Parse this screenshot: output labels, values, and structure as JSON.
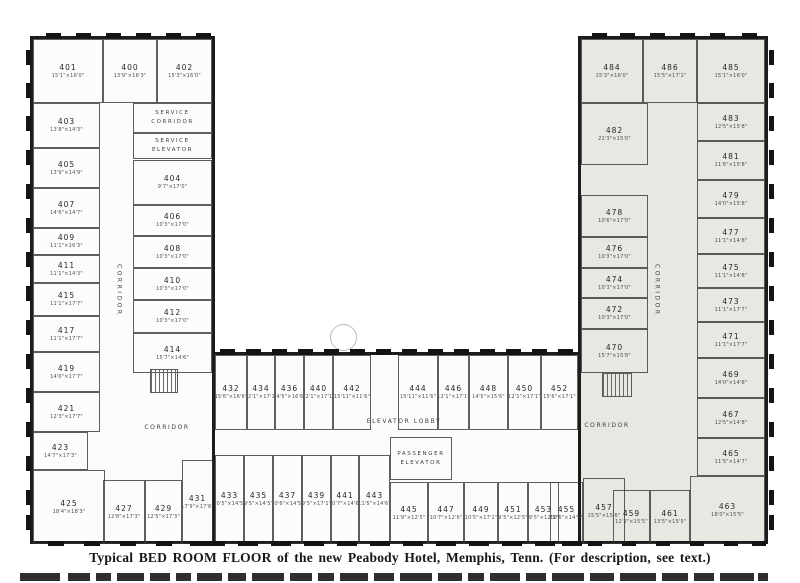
{
  "caption": "Typical BED ROOM FLOOR of the new Peabody Hotel, Memphis, Tenn.   (For description, see text.)",
  "labels": {
    "corridor": "CORRIDOR",
    "service_corridor": "SERVICE CORRIDOR",
    "service_elevator": "SERVICE ELEVATOR",
    "elevator_lobby": "ELEVATOR LOBBY",
    "passenger_elevator": "PASSENGER ELEVATOR"
  },
  "colors": {
    "paper": "#ffffff",
    "ink": "#1c1c1c",
    "right_wing_fill": "#e8e7e2",
    "annotation_circle": "#b7bac9"
  },
  "rooms": [
    {
      "number": "401",
      "dims": "15'1\"×16'0\""
    },
    {
      "number": "400",
      "dims": "13'9\"×16'3\""
    },
    {
      "number": "402",
      "dims": "15'3\"×16'0\""
    },
    {
      "number": "403",
      "dims": "13'8\"×14'3\""
    },
    {
      "number": "405",
      "dims": "13'9\"×14'9\""
    },
    {
      "number": "407",
      "dims": "14'6\"×14'7\""
    },
    {
      "number": "409",
      "dims": "11'1\"×16'3\""
    },
    {
      "number": "411",
      "dims": "11'1\"×14'3\""
    },
    {
      "number": "415",
      "dims": "11'1\"×17'7\""
    },
    {
      "number": "417",
      "dims": "11'1\"×17'7\""
    },
    {
      "number": "419",
      "dims": "14'0\"×17'7\""
    },
    {
      "number": "421",
      "dims": "12'3\"×17'7\""
    },
    {
      "number": "423",
      "dims": "14'7\"×17'3\""
    },
    {
      "number": "425",
      "dims": "18'4\"×18'3\""
    },
    {
      "number": "427",
      "dims": "12'8\"×17'3\""
    },
    {
      "number": "429",
      "dims": "12'5\"×17'3\""
    },
    {
      "number": "431",
      "dims": "17'9\"×17'6\""
    },
    {
      "number": "404",
      "dims": "9'7\"×17'0\""
    },
    {
      "number": "406",
      "dims": "10'3\"×17'0\""
    },
    {
      "number": "408",
      "dims": "10'3\"×17'0\""
    },
    {
      "number": "410",
      "dims": "10'3\"×17'0\""
    },
    {
      "number": "412",
      "dims": "10'3\"×17'0\""
    },
    {
      "number": "414",
      "dims": "15'7\"×14'6\""
    },
    {
      "number": "432",
      "dims": "15'6\"×16'6\""
    },
    {
      "number": "434",
      "dims": "12'1\"×17'1\""
    },
    {
      "number": "436",
      "dims": "14'5\"×16'6\""
    },
    {
      "number": "440",
      "dims": "12'1\"×17'1\""
    },
    {
      "number": "442",
      "dims": "15'11\"×11'6\""
    },
    {
      "number": "444",
      "dims": "15'11\"×11'6\""
    },
    {
      "number": "446",
      "dims": "12'1\"×17'1\""
    },
    {
      "number": "448",
      "dims": "14'5\"×15'6\""
    },
    {
      "number": "450",
      "dims": "12'1\"×17'1\""
    },
    {
      "number": "452",
      "dims": "15'6\"×17'1\""
    },
    {
      "number": "433",
      "dims": "10'5\"×14'5\""
    },
    {
      "number": "435",
      "dims": "9'5\"×14'5\""
    },
    {
      "number": "437",
      "dims": "10'6\"×14'5\""
    },
    {
      "number": "439",
      "dims": "9'5\"×17'1\""
    },
    {
      "number": "441",
      "dims": "10'7\"×14'6\""
    },
    {
      "number": "443",
      "dims": "11'5\"×14'6\""
    },
    {
      "number": "445",
      "dims": "11'9\"×12'5\""
    },
    {
      "number": "447",
      "dims": "10'7\"×12'6\""
    },
    {
      "number": "449",
      "dims": "10'5\"×17'1\""
    },
    {
      "number": "451",
      "dims": "9'5\"×12'5\""
    },
    {
      "number": "453",
      "dims": "9'5\"×12'5\""
    },
    {
      "number": "455",
      "dims": "10'6\"×14'5\""
    },
    {
      "number": "457",
      "dims": "15'5\"×15'6\""
    },
    {
      "number": "459",
      "dims": "12'3\"×15'5\""
    },
    {
      "number": "461",
      "dims": "13'5\"×15'5\""
    },
    {
      "number": "463",
      "dims": "18'0\"×15'5\""
    },
    {
      "number": "465",
      "dims": "11'5\"×14'7\""
    },
    {
      "number": "467",
      "dims": "12'5\"×14'8\""
    },
    {
      "number": "469",
      "dims": "14'0\"×14'8\""
    },
    {
      "number": "471",
      "dims": "11'1\"×17'7\""
    },
    {
      "number": "473",
      "dims": "11'1\"×17'7\""
    },
    {
      "number": "475",
      "dims": "11'1\"×14'8\""
    },
    {
      "number": "477",
      "dims": "11'1\"×14'8\""
    },
    {
      "number": "479",
      "dims": "14'0\"×15'8\""
    },
    {
      "number": "481",
      "dims": "11'6\"×15'8\""
    },
    {
      "number": "483",
      "dims": "12'5\"×15'8\""
    },
    {
      "number": "482",
      "dims": "21'3\"×15'0\""
    },
    {
      "number": "478",
      "dims": "10'6\"×17'0\""
    },
    {
      "number": "476",
      "dims": "10'3\"×17'0\""
    },
    {
      "number": "474",
      "dims": "10'3\"×17'0\""
    },
    {
      "number": "472",
      "dims": "10'3\"×17'0\""
    },
    {
      "number": "470",
      "dims": "15'7\"×15'8\""
    },
    {
      "number": "484",
      "dims": "15'3\"×16'0\""
    },
    {
      "number": "486",
      "dims": "15'5\"×17'1\""
    },
    {
      "number": "485",
      "dims": "15'1\"×16'0\""
    }
  ]
}
